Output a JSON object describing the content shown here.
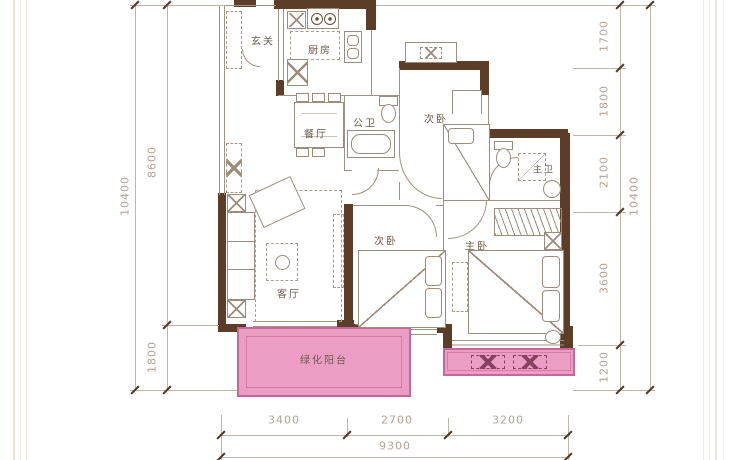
{
  "floorplan": {
    "rooms": [
      {
        "name": "entry",
        "label": "玄关"
      },
      {
        "name": "kitchen",
        "label": "厨房"
      },
      {
        "name": "dining-room",
        "label": "餐厅"
      },
      {
        "name": "public-bathroom",
        "label": "公卫"
      },
      {
        "name": "second-bedroom-top",
        "label": "次卧"
      },
      {
        "name": "master-bathroom",
        "label": "主卫"
      },
      {
        "name": "living-room",
        "label": "客厅"
      },
      {
        "name": "second-bedroom-bottom",
        "label": "次卧"
      },
      {
        "name": "master-bedroom",
        "label": "主卧"
      },
      {
        "name": "green-balcony",
        "label": "绿化阳台"
      }
    ],
    "colors": {
      "wall": "#5c3e28",
      "thin_line": "#a29282",
      "balcony_fill": "#eb9dc3",
      "balcony_border": "#c4689a",
      "dimension_text": "#b3a496",
      "room_label_text": "#6a594a"
    }
  },
  "dimensions": {
    "left": {
      "total": "10400",
      "segments": [
        "8600",
        "1800"
      ]
    },
    "right": {
      "total": "10400",
      "segments": [
        "1700",
        "1800",
        "2100",
        "3600",
        "1200"
      ]
    },
    "bottom": {
      "total": "9300",
      "segments": [
        "3400",
        "2700",
        "3200"
      ]
    }
  }
}
